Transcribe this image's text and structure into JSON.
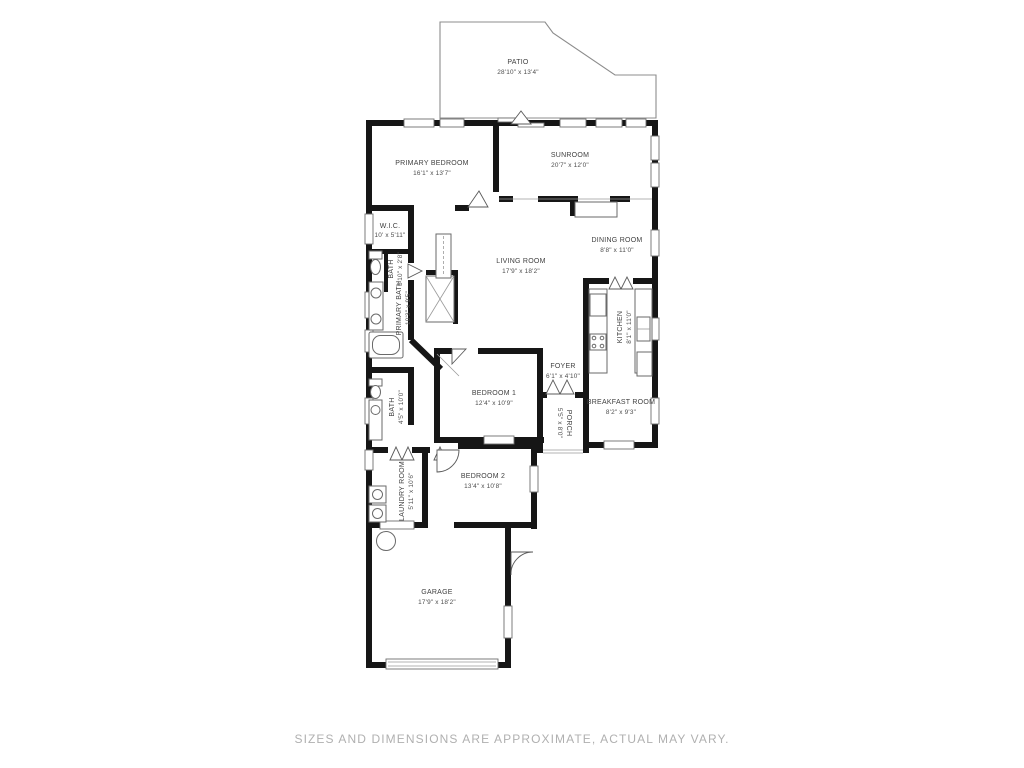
{
  "rooms": {
    "patio": {
      "name": "PATIO",
      "dims": "28'10\" x 13'4\""
    },
    "primary_bedroom": {
      "name": "PRIMARY BEDROOM",
      "dims": "16'1\" x 13'7\""
    },
    "sunroom": {
      "name": "SUNROOM",
      "dims": "20'7\" x 12'0\""
    },
    "wic": {
      "name": "W.I.C.",
      "dims": "10' x 5'11\""
    },
    "bath": {
      "name": "BATH",
      "dims": "5'10\" x 2'8\""
    },
    "primary_bath": {
      "name": "PRIMARY BATH",
      "dims": "10'3\" x 9'5\""
    },
    "living_room": {
      "name": "LIVING ROOM",
      "dims": "17'9\" x 18'2\""
    },
    "dining_room": {
      "name": "DINING ROOM",
      "dims": "8'8\" x 11'0\""
    },
    "kitchen": {
      "name": "KITCHEN",
      "dims": "8'1\" x 11'0\""
    },
    "foyer": {
      "name": "FOYER",
      "dims": "6'1\" x 4'10\""
    },
    "bedroom_1": {
      "name": "BEDROOM 1",
      "dims": "12'4\" x 10'9\""
    },
    "porch": {
      "name": "PORCH",
      "dims": "5'5\" x 8'0\""
    },
    "breakfast_room": {
      "name": "BREAKFAST ROOM",
      "dims": "8'2\" x 9'3\""
    },
    "bath_2": {
      "name": "BATH",
      "dims": "4'5\" x 10'0\""
    },
    "laundry_room": {
      "name": "LAUNDRY ROOM",
      "dims": "5'11\" x 10'6\""
    },
    "bedroom_2": {
      "name": "BEDROOM 2",
      "dims": "13'4\" x 10'8\""
    },
    "garage": {
      "name": "GARAGE",
      "dims": "17'9\" x 18'2\""
    }
  },
  "footer": {
    "disclaimer": "SIZES AND DIMENSIONS ARE APPROXIMATE, ACTUAL MAY VARY."
  },
  "colors": {
    "wall": "#161616",
    "label": "#414141",
    "disclaimer": "#b0b0b0"
  }
}
